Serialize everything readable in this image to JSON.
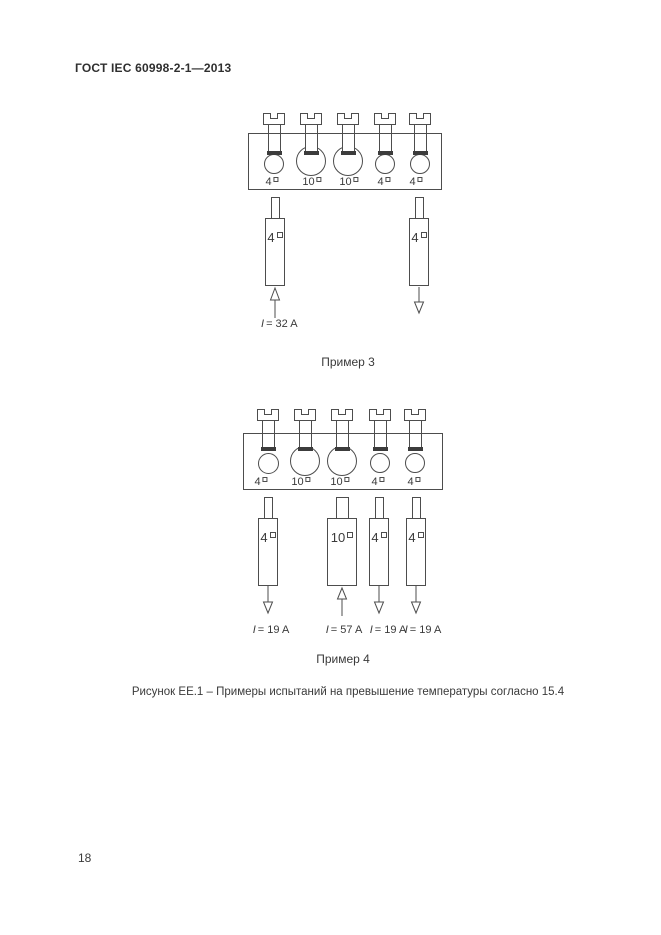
{
  "page": {
    "header": "ГОСТ IEC 60998-2-1—2013",
    "page_number": "18",
    "figure_caption": "Рисунок ЕЕ.1 – Примеры испытаний на превышение температуры согласно 15.4"
  },
  "colors": {
    "ink": "#4d4d4d",
    "paper": "#ffffff",
    "screw_tip_fill": "#3c3c3c"
  },
  "example3": {
    "caption": "Пример 3",
    "terminal_labels": [
      "4",
      "10",
      "10",
      "4",
      "4"
    ],
    "conductors": [
      {
        "size": "4",
        "direction": "up",
        "current_symbol": "I",
        "current_value": "= 32 A"
      },
      {
        "size": "4",
        "direction": "down",
        "current_symbol": "",
        "current_value": ""
      }
    ]
  },
  "example4": {
    "caption": "Пример 4",
    "terminal_labels": [
      "4",
      "10",
      "10",
      "4",
      "4"
    ],
    "conductors": [
      {
        "size": "4",
        "direction": "down",
        "current_symbol": "I",
        "current_value": "= 19 A"
      },
      {
        "size": "10",
        "direction": "up",
        "current_symbol": "I",
        "current_value": "= 57 A"
      },
      {
        "size": "4",
        "direction": "down",
        "current_symbol": "I",
        "current_value": "= 19 A"
      },
      {
        "size": "4",
        "direction": "down",
        "current_symbol": "I",
        "current_value": "= 19 A"
      }
    ]
  }
}
